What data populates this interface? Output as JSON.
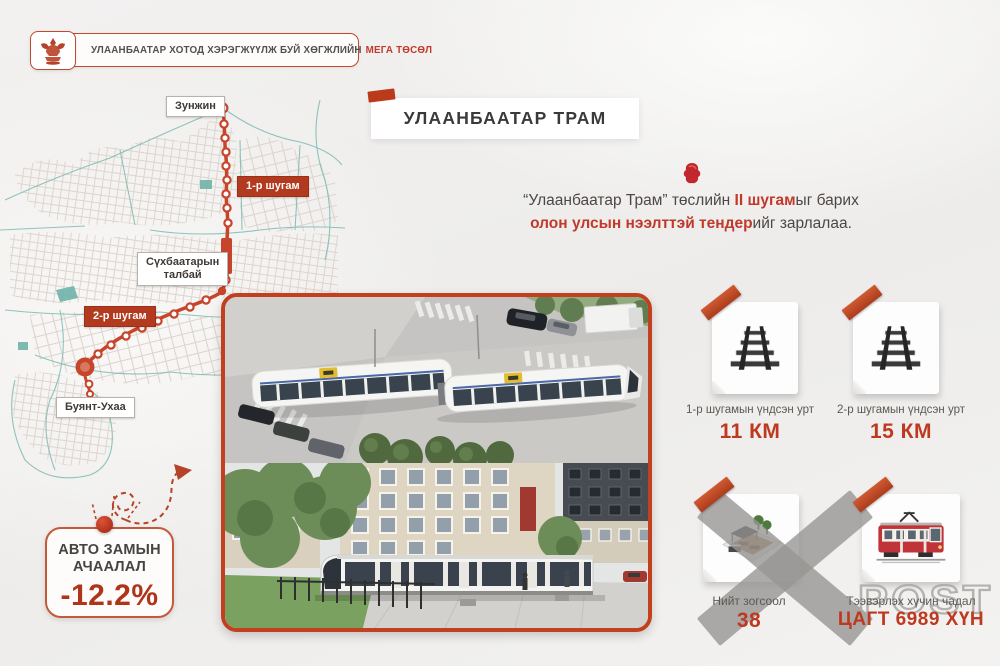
{
  "header": {
    "badge_text": "УЛААНБААТАР ХОТОД ХЭРЭГЖҮҮЛЖ БУЙ ХӨГЖЛИЙН",
    "badge_highlight": "МЕГА ТӨСӨЛ"
  },
  "title_card": {
    "title": "УЛААНБААТАР ТРАМ"
  },
  "announcement": {
    "line1_prefix": "“Улаанбаатар Трам” төслийн ",
    "line1_highlight": "II шугам",
    "line1_suffix": "ыг барих",
    "line2_highlight": "олон улсын нээлттэй тендер",
    "line2_suffix": "ийг зарлалаа."
  },
  "map": {
    "station_zunjin": "Зунжин",
    "line1_label": "1-р шугам",
    "station_sukhbaatar_line1": "Сүхбаатарын",
    "station_sukhbaatar_line2": "талбай",
    "line2_label": "2-р шугам",
    "station_buyant": "Буянт-Ухаа"
  },
  "stats": [
    {
      "label": "1-р шугамын үндсэн урт",
      "value": "11 КМ",
      "icon": "railway-track-icon"
    },
    {
      "label": "2-р шугамын үндсэн урт",
      "value": "15 КМ",
      "icon": "railway-track-icon"
    },
    {
      "label": "Нийт зогсоол",
      "value": "38",
      "icon": "tram-stop-icon"
    },
    {
      "label": "Тээвэрлэх хүчин чадал",
      "value": "ЦАГТ 6989 ХҮН",
      "icon": "tram-icon"
    }
  ],
  "road_load_card": {
    "label_line1": "АВТО ЗАМЫН",
    "label_line2": "АЧААЛАЛ",
    "value": "-12.2%"
  },
  "watermark": {
    "letter": "X",
    "word": "POST"
  },
  "colors": {
    "accent_red": "#b5391f",
    "value_red": "#bd3a20",
    "route_red": "#c7452a",
    "teal_boundary": "#7dbab3",
    "text_dark": "#4a4542"
  }
}
